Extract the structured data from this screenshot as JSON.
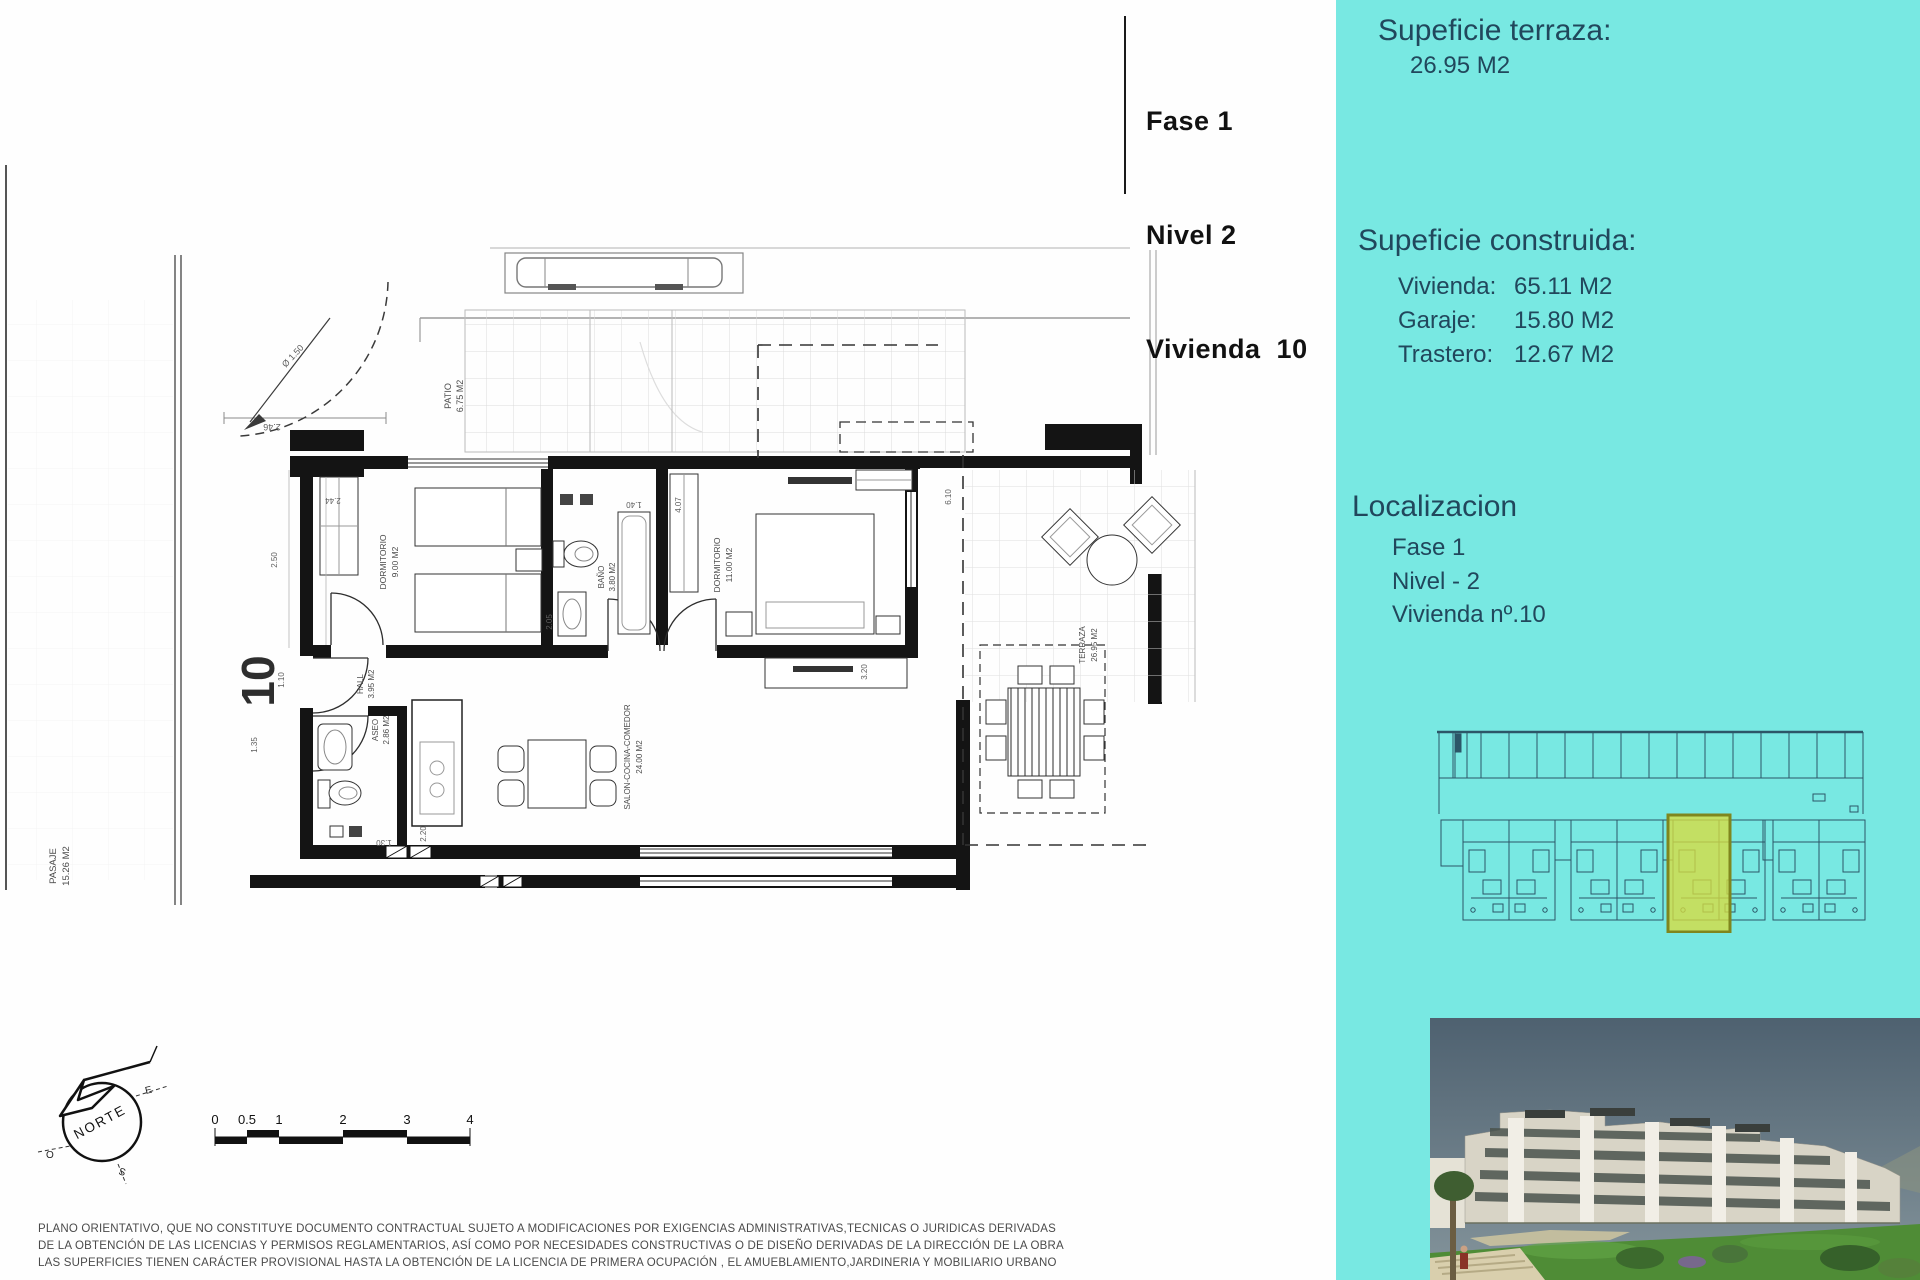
{
  "title_block": {
    "line1": "Fase 1",
    "line2": "Nivel 2",
    "line3": "Vivienda  10"
  },
  "sidebar": {
    "terrace_heading": "Supeficie terraza:",
    "terrace_value": "26.95 M2",
    "built_heading": "Supeficie construida:",
    "built_rows": [
      {
        "label": "Vivienda:",
        "value": "65.11 M2"
      },
      {
        "label": "Garaje:",
        "value": "15.80 M2"
      },
      {
        "label": "Trastero:",
        "value": "12.67 M2"
      }
    ],
    "localization_heading": "Localizacion",
    "localization_lines": [
      "Fase 1",
      "Nivel - 2",
      "Vivienda nº.10"
    ],
    "colors": {
      "panel": "#78e8e2",
      "text": "#21475c",
      "highlight": "#d9dc3f"
    }
  },
  "plan": {
    "unit_number": "10",
    "rooms": {
      "patio": {
        "name": "PATIO",
        "area": "6.75 M2"
      },
      "dormitorio_1": {
        "name": "DORMITORIO",
        "area": "9.00 M2"
      },
      "bano": {
        "name": "BAÑO",
        "area": "3.80 M2"
      },
      "dormitorio_2": {
        "name": "DORMITORIO",
        "area": "11.00 M2"
      },
      "salon": {
        "name": "SALON-COCINA-COMEDOR",
        "area": "24.00 M2"
      },
      "hall": {
        "name": "HALL",
        "area": "3.95 M2"
      },
      "aseo": {
        "name": "ASEO",
        "area": "2.86 M2"
      },
      "terraza": {
        "name": "TERRAZA",
        "area": "26.95 M2"
      },
      "pasaje": {
        "name": "PASAJE",
        "area": "15.26 M2"
      }
    },
    "dimensions": {
      "patio_width": "2.46",
      "turn_radius": "Ø 1.50",
      "dorm1_width": "2.44",
      "dorm1_depth": "2.50",
      "hall_width": "1.10",
      "pasillo": "1.35",
      "bano_width": "1.40",
      "bano_depth": "2.05",
      "dorm2_width": "4.07",
      "terraza_depth": "6.10",
      "salon_width": "3.20",
      "cocina_depth": "2.20",
      "paso": "1.30"
    },
    "compass": {
      "label": "NORTE",
      "east": "E",
      "west": "O",
      "south": "S"
    },
    "scale_ticks": [
      "0",
      "0.5",
      "1",
      "2",
      "3",
      "4"
    ]
  },
  "disclaimer": {
    "line1": "PLANO ORIENTATIVO, QUE NO CONSTITUYE DOCUMENTO CONTRACTUAL SUJETO A MODIFICACIONES POR EXIGENCIAS ADMINISTRATIVAS,TECNICAS O JURIDICAS DERIVADAS",
    "line2": "DE LA OBTENCIÓN DE LAS LICENCIAS Y PERMISOS REGLAMENTARIOS, ASÍ COMO POR NECESIDADES CONSTRUCTIVAS  O DE DISEÑO DERIVADAS DE LA DIRECCIÓN DE LA OBRA",
    "line3": "LAS SUPERFICIES TIENEN CARÁCTER PROVISIONAL HASTA LA OBTENCIÓN DE LA LICENCIA DE PRIMERA OCUPACIÓN , EL AMUEBLAMIENTO,JARDINERIA Y MOBILIARIO URBANO"
  }
}
